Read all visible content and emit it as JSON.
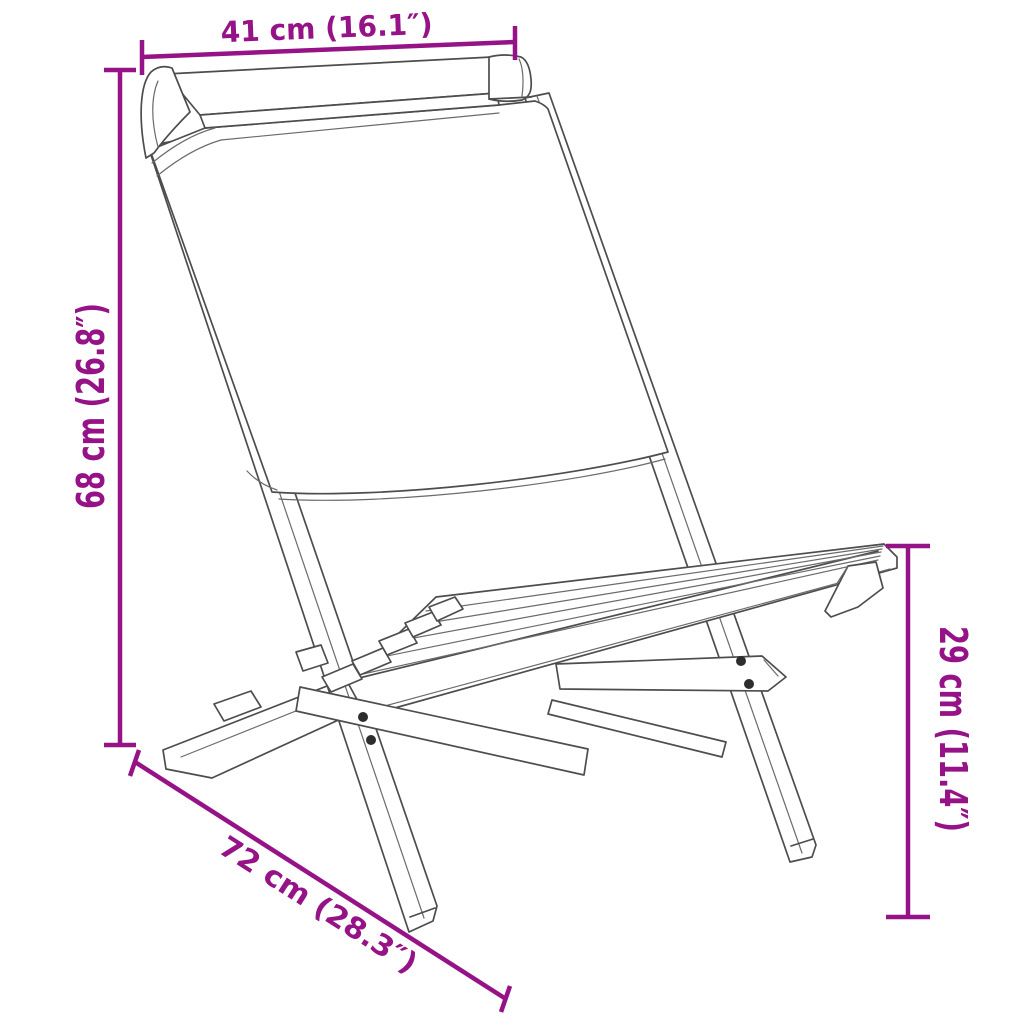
{
  "diagram": {
    "type": "product-dimension-drawing",
    "subject": "folding-chair-line-art",
    "dimensions": {
      "top_width": {
        "label": "41 cm (16.1″)"
      },
      "back_height": {
        "label": "68 cm (26.8″)"
      },
      "seat_height": {
        "label": "29 cm (11.4″)"
      },
      "depth": {
        "label": "72 cm (28.3″)"
      }
    },
    "colors": {
      "dimension_lines": "#951287",
      "drawing_lines": "#4D4D4D",
      "background": "#FFFFFF"
    }
  }
}
